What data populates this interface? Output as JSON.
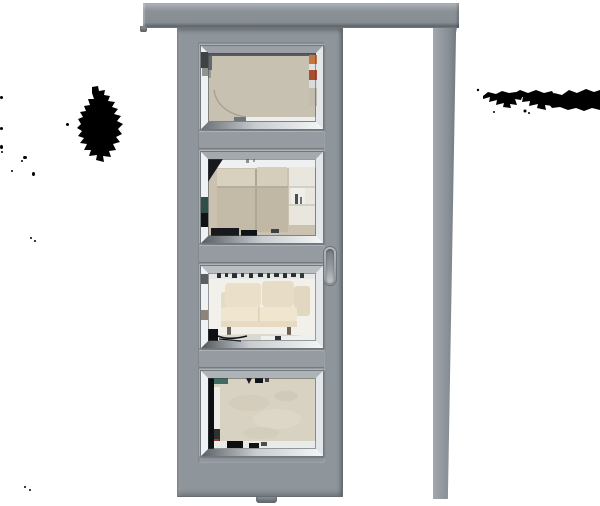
{
  "scene": {
    "label": "product image of a grey sliding pocket door with four beveled glass panes, on white background"
  },
  "door": {
    "pane_count": 4,
    "hardware": [
      "ceiling-track",
      "wall-post",
      "flush-pull-handle",
      "floor-guide"
    ]
  },
  "panes": [
    {
      "id": 1,
      "reflection": "plain beige wall with faint lamp arc"
    },
    {
      "id": 2,
      "reflection": "beige wardrobe cabinets with open white shelving"
    },
    {
      "id": 3,
      "reflection": "cream sofa on light floor"
    },
    {
      "id": 4,
      "reflection": "beige plaster textured wall with dark shelf band"
    }
  ],
  "artifacts": {
    "description": "irregular black mask blobs left and right of door, plus small black specks",
    "color": "#000000"
  },
  "colors": {
    "background": "#ffffff",
    "door": "#8e959b",
    "track": "#8a9197",
    "artifact": "#000000",
    "bevel_silver": "#e7eaec",
    "bevel_dark_line": "#3e4347",
    "glass1": "#c7c1b2",
    "glass2": "#cac1b0",
    "glass3": "#f2f0ea",
    "glass4": "#d8d2c2",
    "sofa_cream": "#eadfc9",
    "cabinet_beige": "#c4baa8",
    "teal_accent": "#3f6b64",
    "handle": "#9aa0a5"
  }
}
